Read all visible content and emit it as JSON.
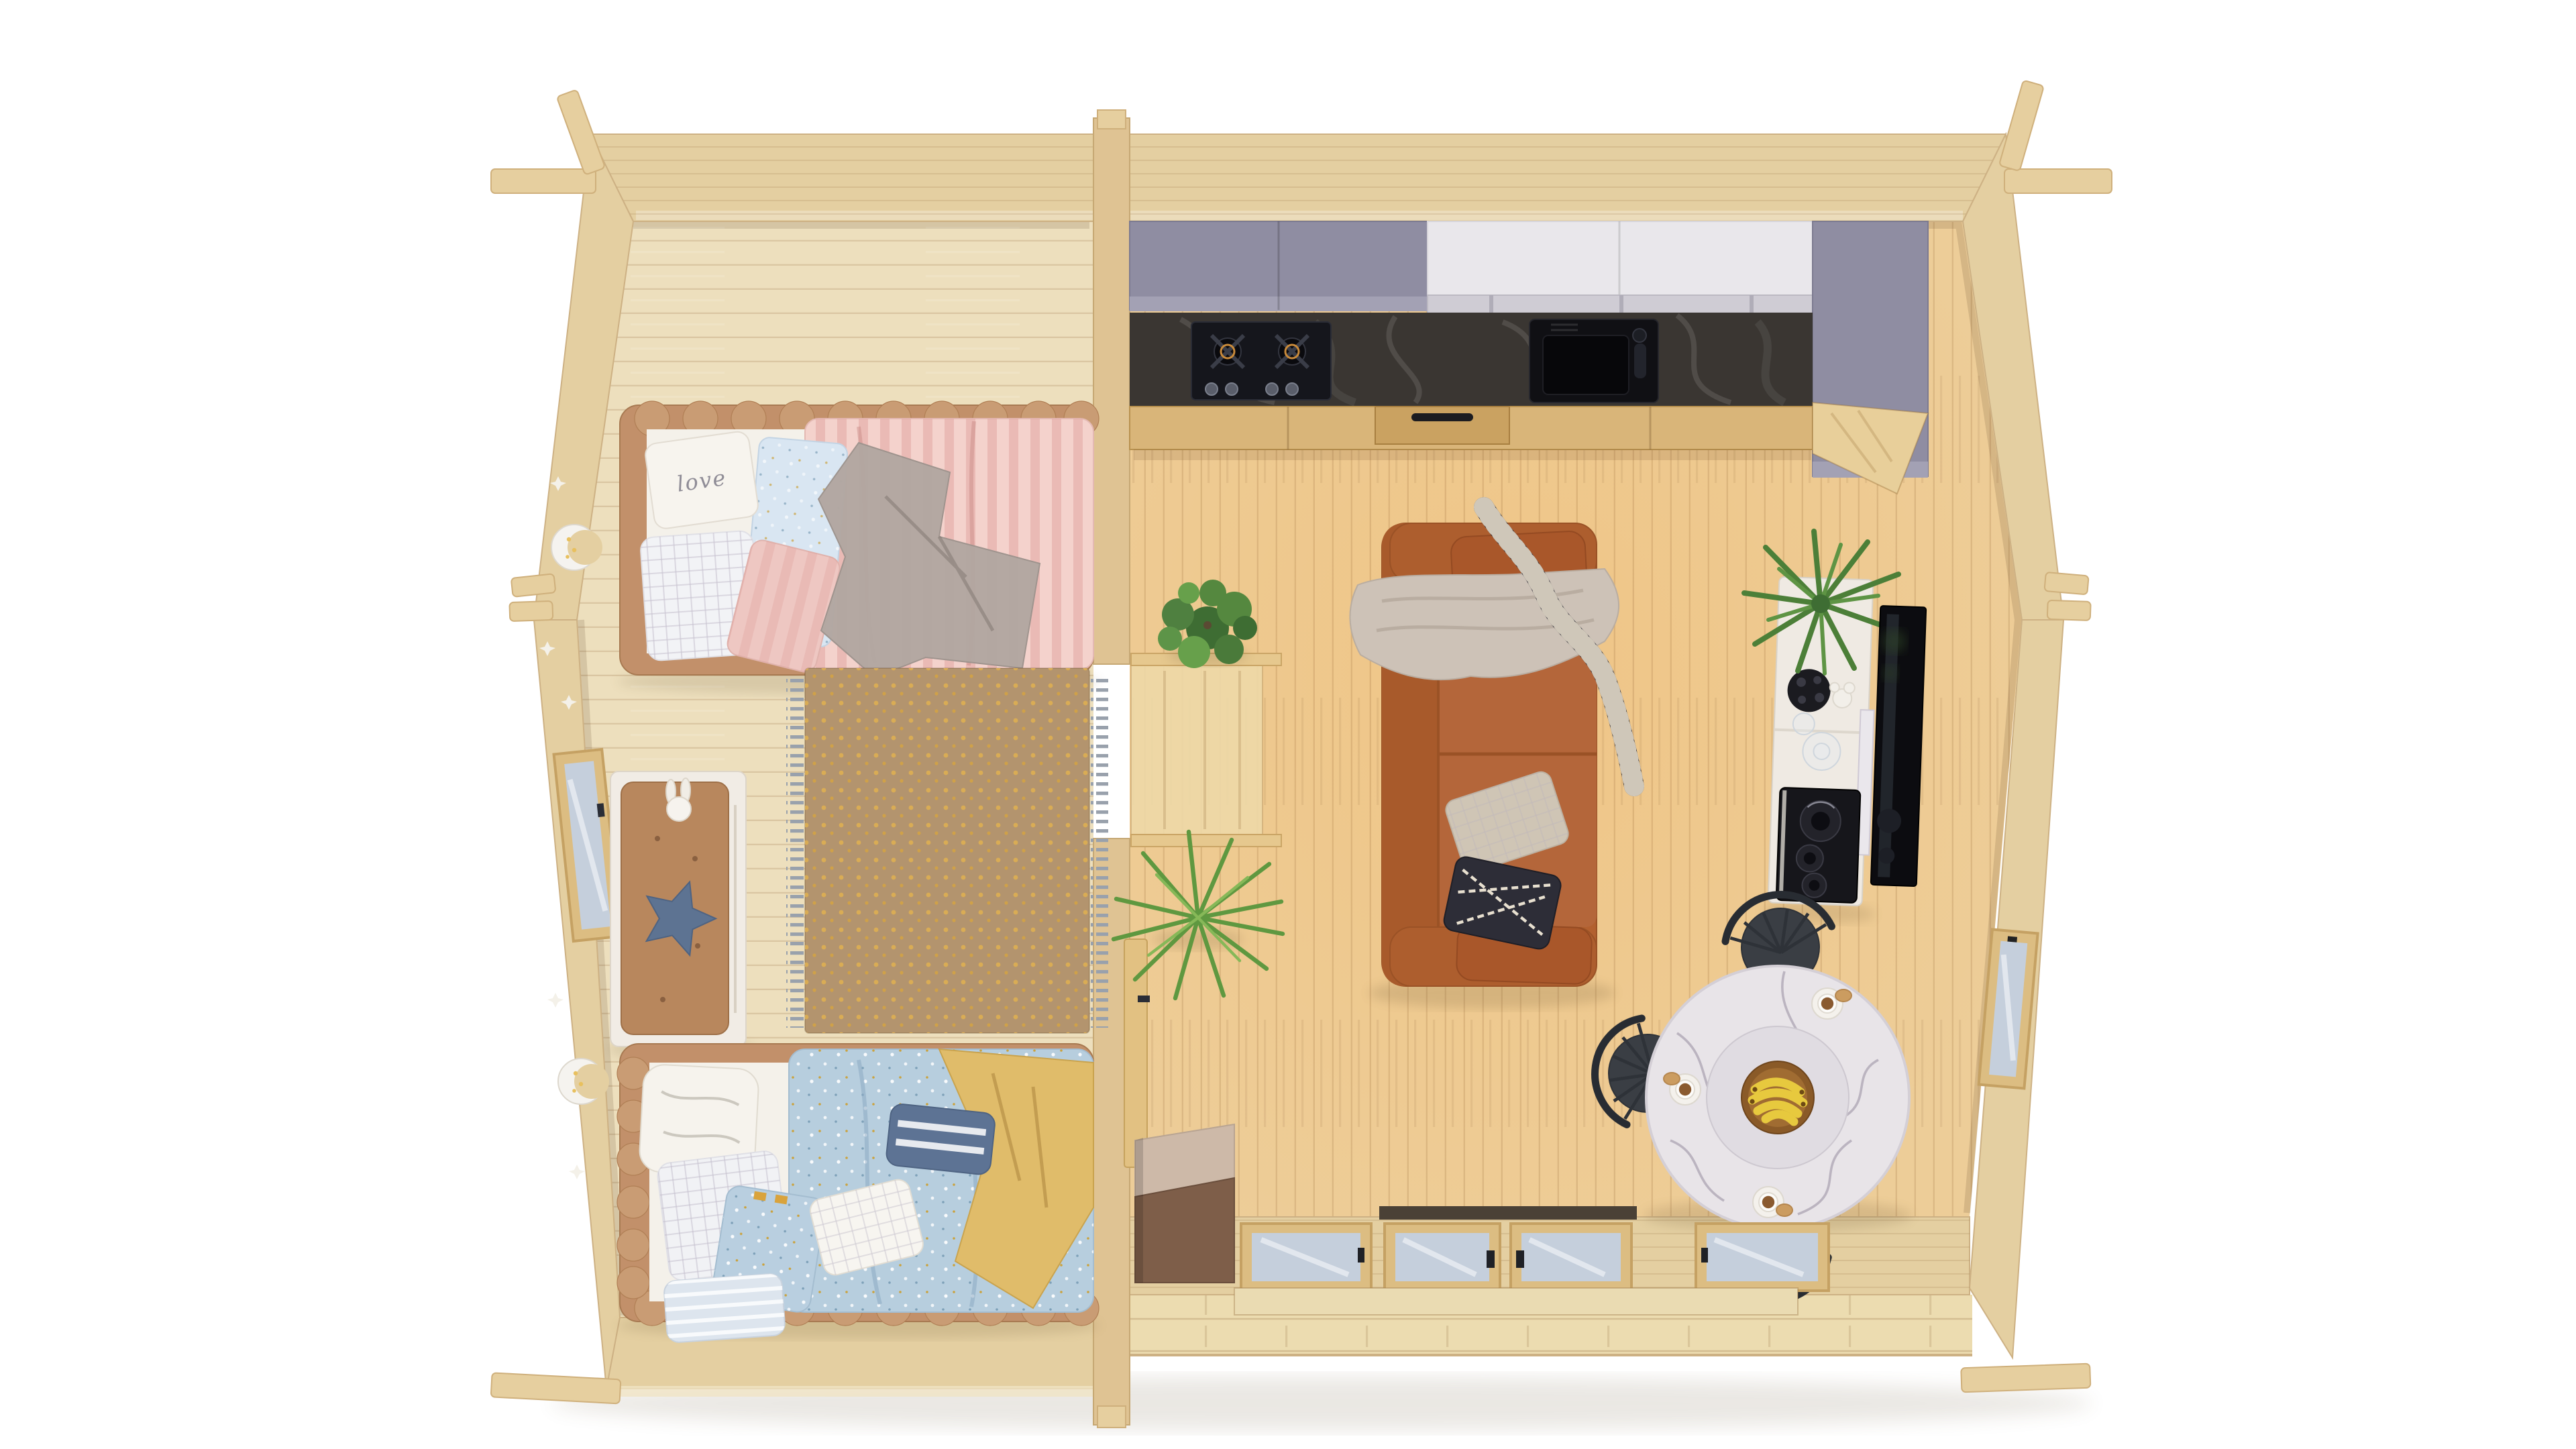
{
  "scene": {
    "type": "3d-render-top-view",
    "setting": "log cabin floor plan, top-down view, white background",
    "rooms_count": 2
  },
  "texts": {
    "love_pillow": "love"
  },
  "palette": {
    "background": "#ffffff",
    "wall_wood": "#e4cfa1",
    "wall_edge": "#cdb184",
    "divider_wood": "#dfc393",
    "bedroom_floor": "#eddfbd",
    "living_floor": "#edcd98",
    "deck_wood": "#ecdcb0",
    "log_wood": "#e6cf9f",
    "bed_frame_tan": "#c2906a",
    "bedding_white": "#f4f1ea",
    "duvet_pink": "#f4d2cc",
    "duvet_blue": "#b7cede",
    "throw_yellow": "#e0bc6a",
    "blanket_gray": "#b2a7a1",
    "rug_tan": "#b3946e",
    "bench_white": "#f1ece5",
    "bench_cushion": "#b8875d",
    "sofa_rust": "#b2602f",
    "sofa_throw": "#cdc2b7",
    "scarf_dark": "#2d2d37",
    "kitchen_gray": "#8f8da2",
    "kitchen_white": "#e9e7eb",
    "counter_dark": "#3a3632",
    "cabinet_wood": "#d9b579",
    "console_white": "#efeae3",
    "tv_black": "#0c0c10",
    "table_marble": "#e8e4e8",
    "chair_black": "#3a3e44",
    "plant_green": "#4f8040",
    "glass_blue": "#c5cfdc",
    "shadow": "#5a4628"
  },
  "bedroom": {
    "label": "Kids bedroom",
    "items": [
      {
        "id": "bed-pink",
        "label": "Single bed, tan tufted frame, pink striped duvet, grey star blanket"
      },
      {
        "id": "love-pillow",
        "label": "White pillow with script lettering"
      },
      {
        "id": "bed-blue",
        "label": "Single bed, tan tufted frame, blue speckled duvet, yellow throw"
      },
      {
        "id": "storage-bench",
        "label": "White storage bench with brown tufted cushion, bunny plush and navy star cushion"
      },
      {
        "id": "rug",
        "label": "Tan rug with golden dots and grey fringe"
      },
      {
        "id": "moon-lamps",
        "label": "Two white crescent night lamps on left wall"
      },
      {
        "id": "star-decals",
        "label": "Small white star wall decals"
      },
      {
        "id": "window-left",
        "label": "Window in angled left wall"
      }
    ]
  },
  "living_room": {
    "label": "Open living room with kitchenette",
    "items": [
      {
        "id": "kitchen-upper-gray",
        "label": "Grey-lavender upper cabinets"
      },
      {
        "id": "kitchen-upper-white",
        "label": "White upper cabinets with open shelf"
      },
      {
        "id": "kitchen-counter",
        "label": "Dark stone countertop"
      },
      {
        "id": "hob",
        "label": "Black 2-burner gas hob with 4 knobs"
      },
      {
        "id": "sink",
        "label": "Black undermount sink with faucet"
      },
      {
        "id": "kitchen-base",
        "label": "Light wood base cabinets with black handle"
      },
      {
        "id": "tall-cabinet",
        "label": "Angled light wood tall cabinet"
      },
      {
        "id": "sofa",
        "label": "Rust-brown sofa with beige throw, patterned scarf and two cushions"
      },
      {
        "id": "plant-ficus",
        "label": "Potted ficus beside doorway"
      },
      {
        "id": "plant-dracaena",
        "label": "Spiky dracaena plant"
      },
      {
        "id": "doorway-shelves",
        "label": "Doorway opening with two wooden rails and open door leaf"
      },
      {
        "id": "console",
        "label": "White sideboard with fern, wire ball, coral, glass bowls and speaker tray"
      },
      {
        "id": "tv",
        "label": "Wall-mounted black TV"
      },
      {
        "id": "dining-table",
        "label": "Round white marble table with banana bowl and three coffees"
      },
      {
        "id": "dining-chairs",
        "label": "Three black spindle-back chairs"
      },
      {
        "id": "entry-cabinet",
        "label": "Taupe entry chest near front door"
      },
      {
        "id": "front-glazing",
        "label": "Four glazed panels including double door in front wall"
      },
      {
        "id": "window-right",
        "label": "Window in angled right wall"
      }
    ]
  },
  "exterior": {
    "items": [
      {
        "id": "deck",
        "label": "Front wooden deck strip"
      },
      {
        "id": "log-joints",
        "label": "Protruding log ends at wall corners"
      }
    ]
  },
  "counts": {
    "beds": 2,
    "dining_chairs": 3,
    "coffee_cups": 3,
    "front_glass_panels": 4,
    "hob_burners": 2,
    "hob_knobs": 4,
    "wall_lamps": 2,
    "plants": 3
  }
}
